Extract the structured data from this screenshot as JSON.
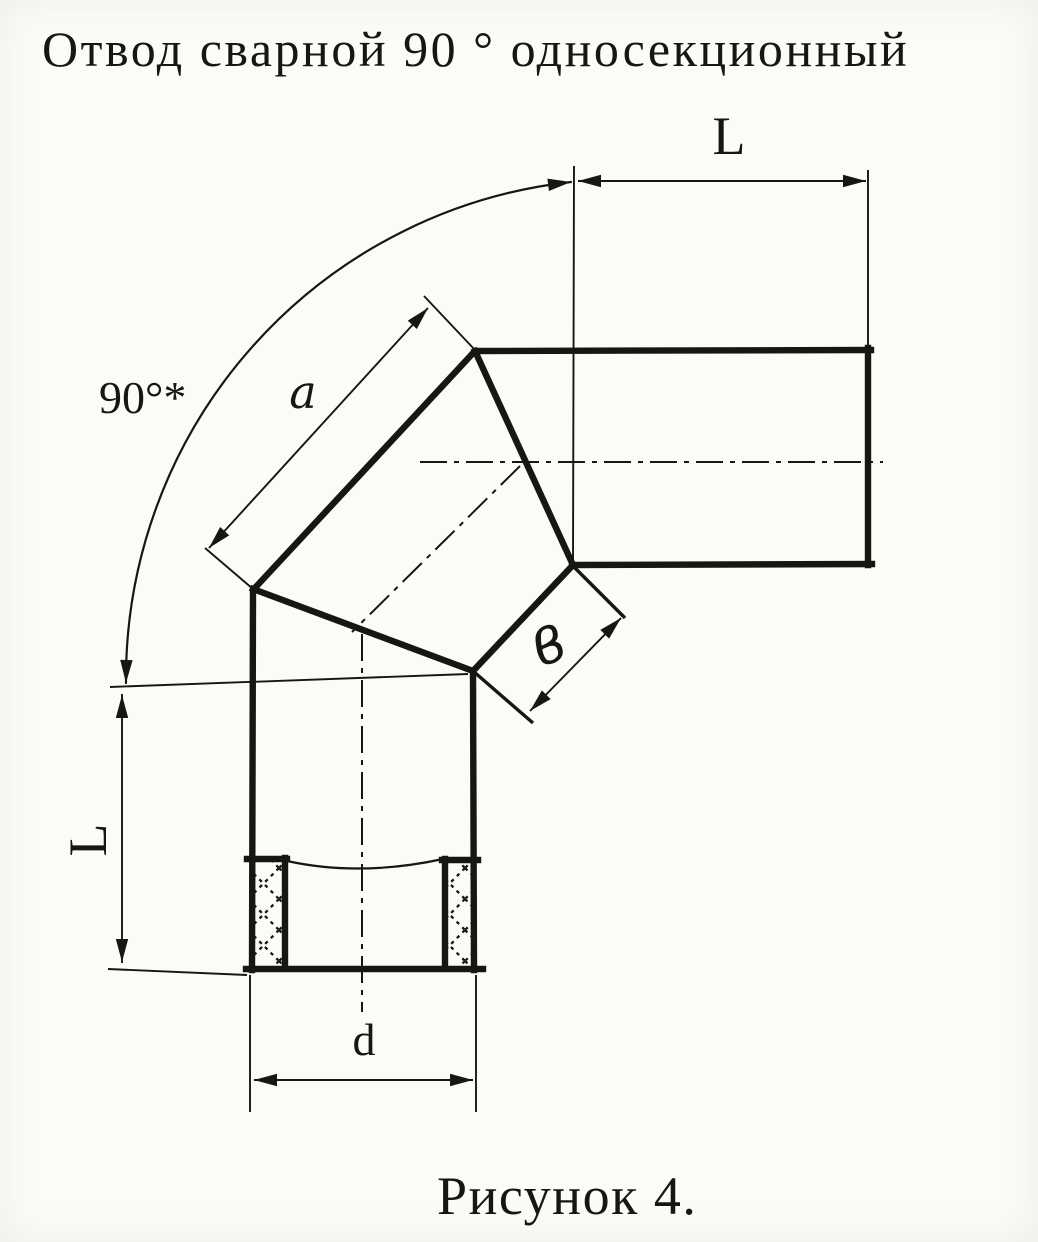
{
  "drawing": {
    "title": "Отвод сварной 90 ° односекционный",
    "caption": "Рисунок 4."
  },
  "dimension_labels": {
    "top_length": "L",
    "left_length": "L",
    "bend_angle": "90°*",
    "outer_section_length": "a",
    "joint_face_width": "в",
    "pipe_diameter": "d"
  },
  "colors": {
    "ink": "#181611",
    "paper": "#fcfbf8"
  }
}
